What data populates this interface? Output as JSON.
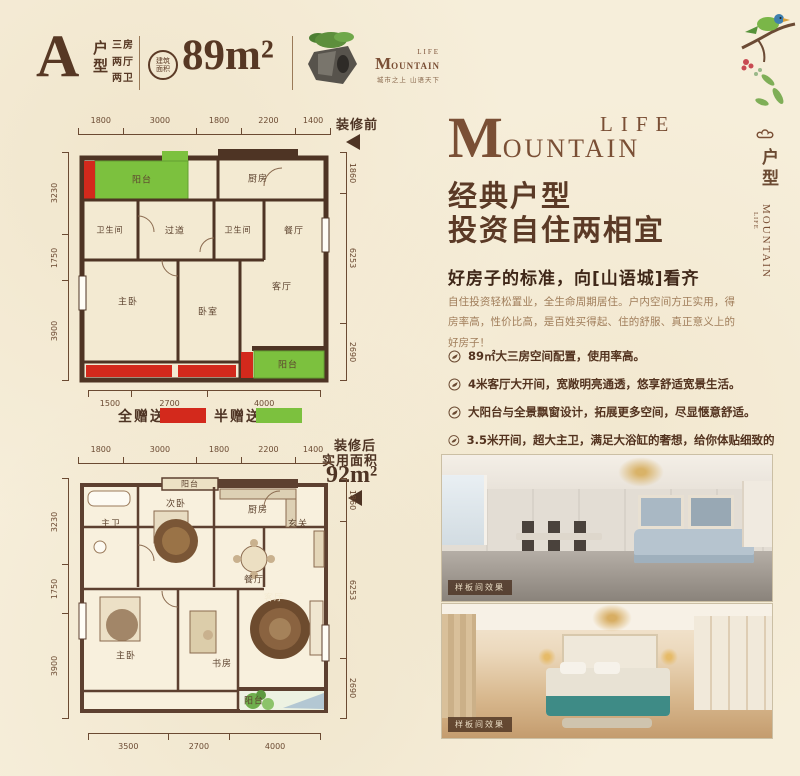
{
  "header": {
    "type_letter": "A",
    "type_label": "户型",
    "rooms": [
      "三房",
      "两厅",
      "两卫"
    ],
    "seal": "建筑面积",
    "area": "89m²",
    "brand": {
      "initial": "M",
      "rest": "OUNTAIN",
      "life": "LIFE",
      "tagline": "城市之上 山语天下"
    }
  },
  "plan_before": {
    "tag": "装修前",
    "dims_top": [
      "1800",
      "3000",
      "1800",
      "2200",
      "1400"
    ],
    "dims_left": [
      "3230",
      "1750",
      "3900"
    ],
    "dims_right": [
      "1860",
      "6253",
      "2690"
    ],
    "dims_bottom": [
      "1500",
      "2700",
      "4000"
    ],
    "rooms": [
      "阳台",
      "厨房",
      "卫生间",
      "过道",
      "卫生间",
      "餐厅",
      "主卧",
      "卧室",
      "客厅",
      "阳台"
    ]
  },
  "legend": {
    "full_label": "全赠送",
    "full_color": "#d3291c",
    "half_label": "半赠送",
    "half_color": "#7cc13e"
  },
  "plan_after": {
    "tag": "装修后",
    "tag2": "实用面积",
    "area": "92m²",
    "dims_top": [
      "1800",
      "3000",
      "1800",
      "2200",
      "1400"
    ],
    "dims_left": [
      "3230",
      "1750",
      "3900"
    ],
    "dims_right": [
      "1860",
      "6253",
      "2690"
    ],
    "dims_bottom": [
      "3500",
      "2700",
      "4000"
    ],
    "rooms": [
      "阳台",
      "厨房",
      "主卫",
      "次卧",
      "玄关",
      "餐厅",
      "主卧",
      "书房",
      "客厅",
      "阳台"
    ]
  },
  "right_col": {
    "brand": {
      "initial": "M",
      "rest": "OUNTAIN",
      "life": "LIFE"
    },
    "headline1": "经典户型",
    "headline2": "投资自住两相宜",
    "subhead": "好房子的标准，向[山语城]看齐",
    "paragraph": "自住投资轻松置业，全生命周期居住。户内空间方正实用，得房率高，性价比高，是百姓买得起、住的舒服、真正意义上的好房子！",
    "bullets": [
      "89㎡大三房空间配置，使用率高。",
      "4米客厅大开间，宽敞明亮通透，悠享舒适宽景生活。",
      "大阳台与全景飘窗设计，拓展更多空间，尽显惬意舒适。",
      "3.5米开间，超大主卫，满足大浴缸的奢想，给你体贴细致的呵护。"
    ],
    "photos": [
      {
        "caption": "样板间效果"
      },
      {
        "caption": "样板间效果"
      }
    ]
  },
  "side_banner": {
    "label": "户型",
    "brand": "MOUNTAIN",
    "brand_sub": "LIFE"
  }
}
